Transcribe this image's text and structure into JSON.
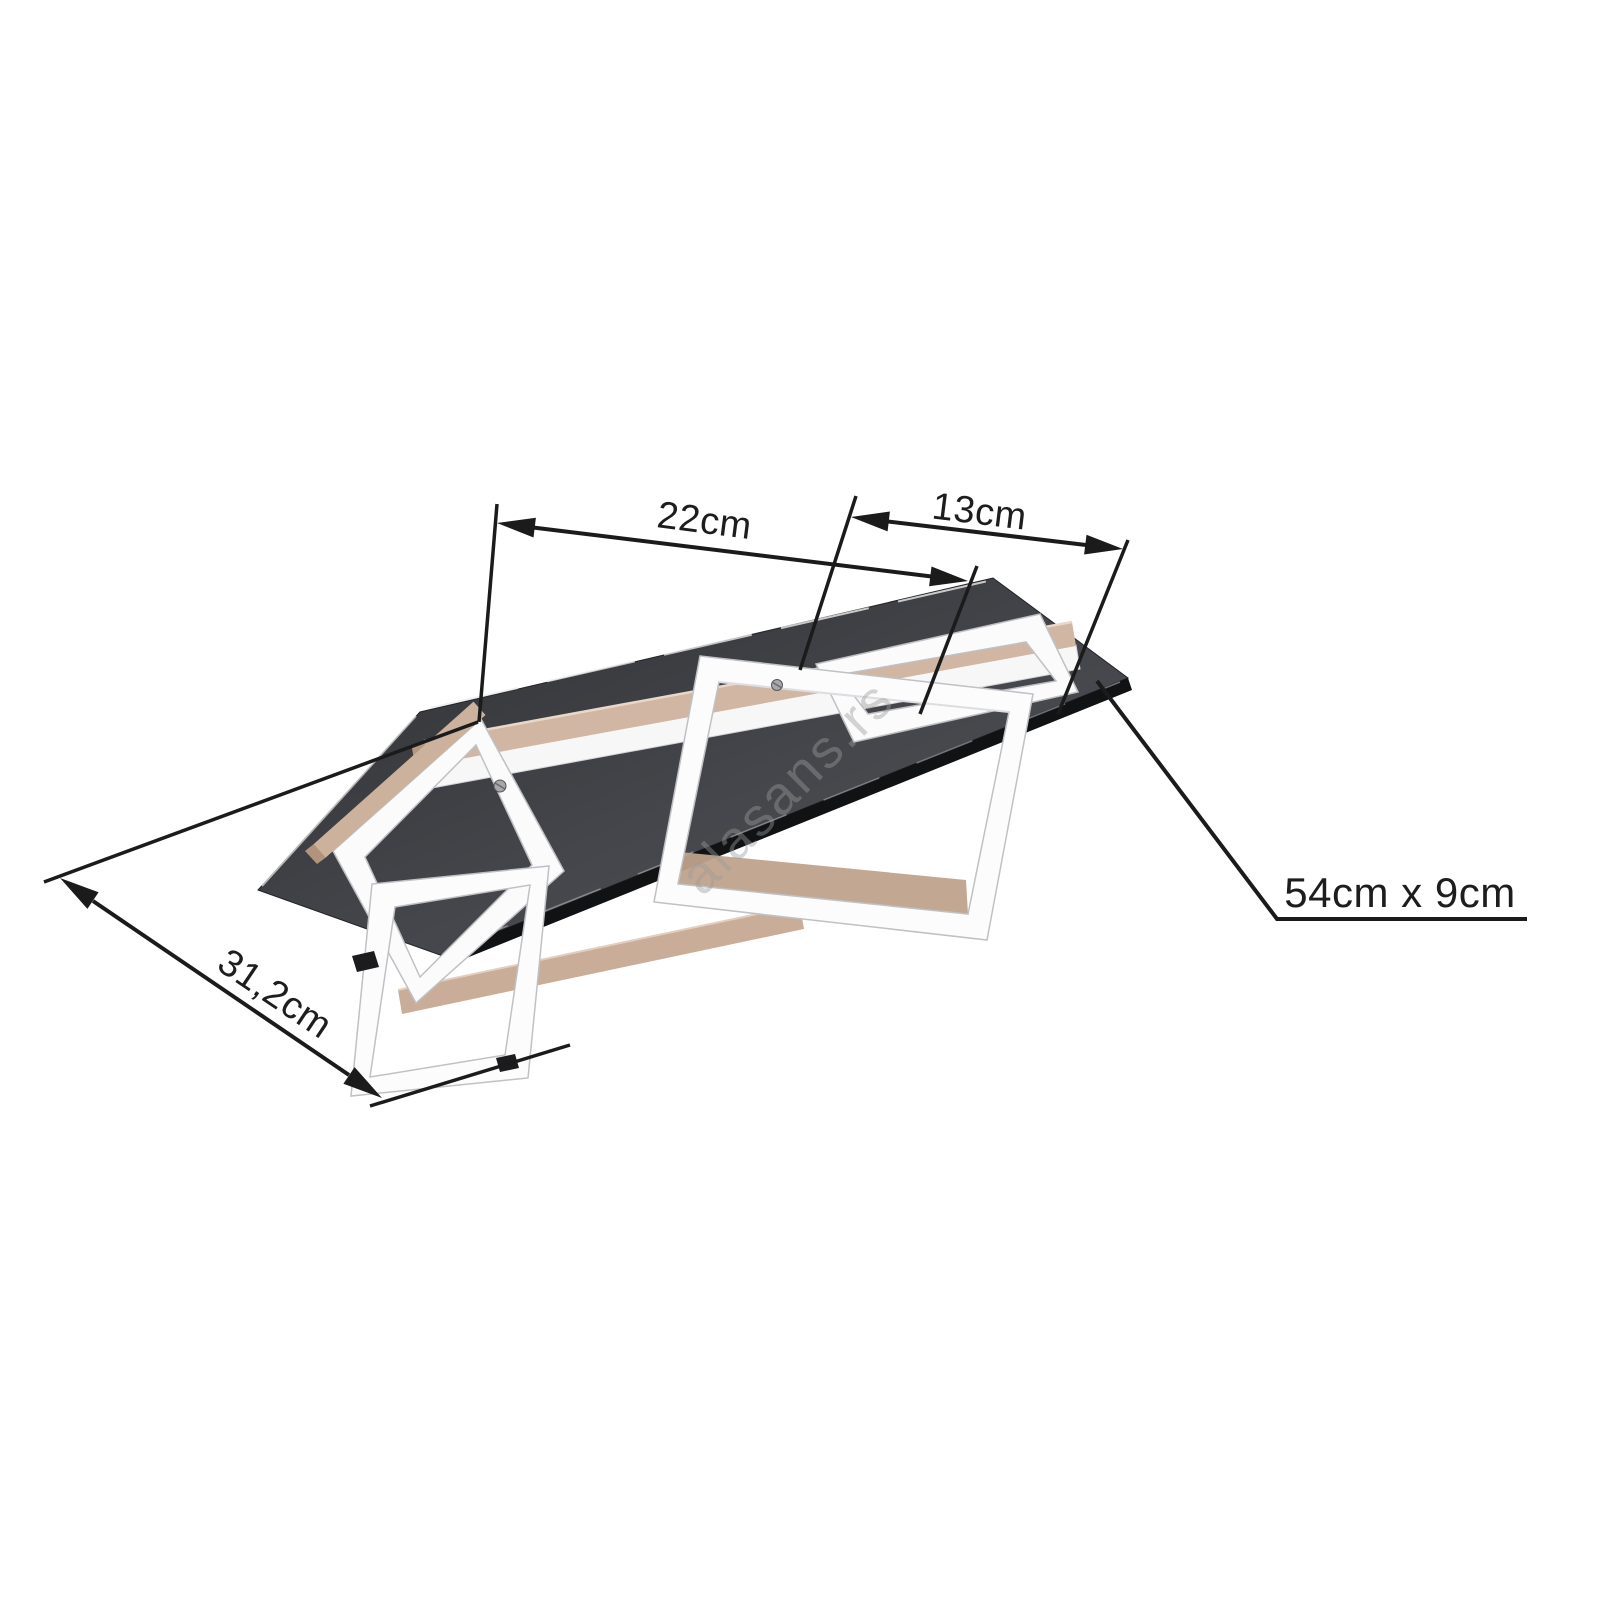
{
  "dimensions": {
    "left_span": "22cm",
    "right_span": "13cm",
    "diagonal_depth": "31,2cm",
    "overall_size": "54cm x 9cm"
  },
  "watermark": "alasans.rs",
  "colors": {
    "dimension_lines": "#1b1b1b",
    "base_plate_dark": "#3c3d42",
    "base_plate_edge": "#111214",
    "wood_tan": "#ccb19d",
    "led_frame_white": "#fbfbfc",
    "background": "#ffffff"
  }
}
